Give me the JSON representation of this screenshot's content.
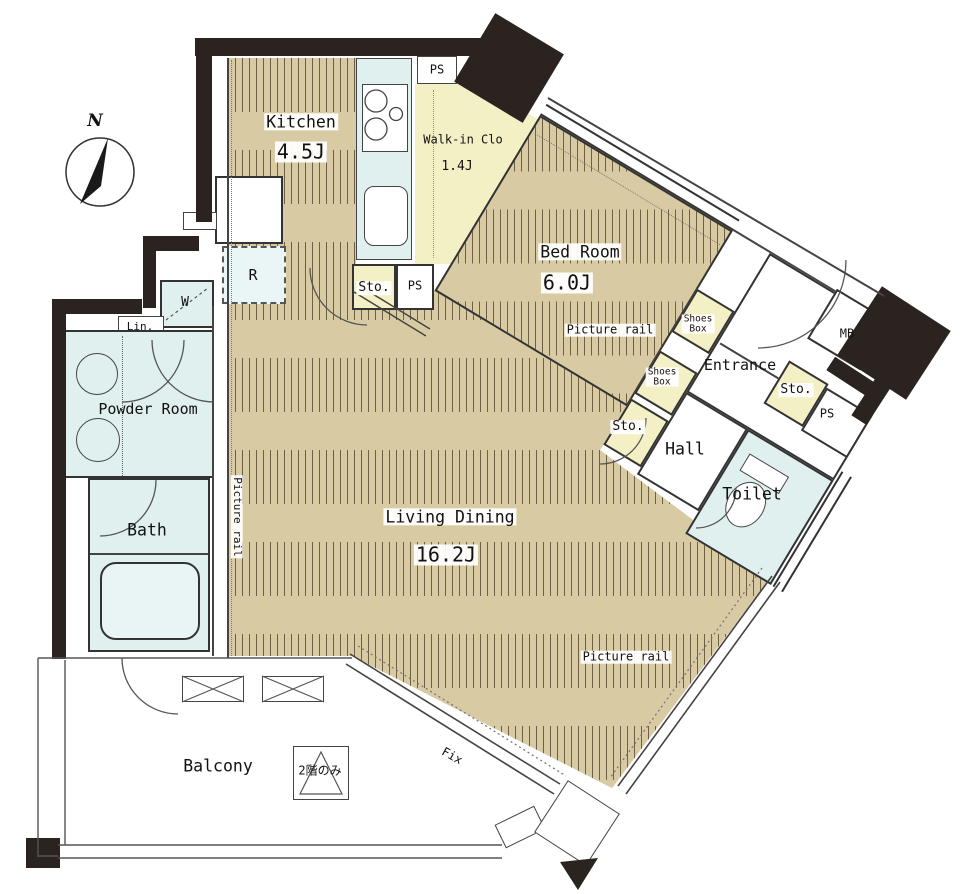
{
  "title": "Apartment floor plan (1LDK + WIC)",
  "labels": {
    "compass_n": "N",
    "kitchen": "Kitchen",
    "kitchen_area": "4.5J",
    "ps": "PS",
    "walk_in_clo": "Walk-in Clo",
    "walk_in_clo_area": "1.4J",
    "bedroom": "Bed Room",
    "bedroom_area": "6.0J",
    "sto": "Sto.",
    "refrigerator": "R",
    "washer": "W",
    "linen": "Lin.",
    "powder_room": "Powder Room",
    "bath": "Bath",
    "picture_rail": "Picture rail",
    "living_dining": "Living Dining",
    "living_dining_area": "16.2J",
    "shoes_box_line1": "Shoes",
    "shoes_box_line2": "Box",
    "entrance": "Entrance",
    "meter_box": "MB",
    "hall": "Hall",
    "toilet": "Toilet",
    "balcony": "Balcony",
    "second_floor_only": "2階のみ",
    "fix": "Fix"
  },
  "colors": {
    "wood_floor": "#d8cba4",
    "wood_stripe": "#6f6044",
    "closet_yellow": "#f4f0c6",
    "water_cyan": "#dff0ef",
    "wall_black": "#2a2320"
  }
}
